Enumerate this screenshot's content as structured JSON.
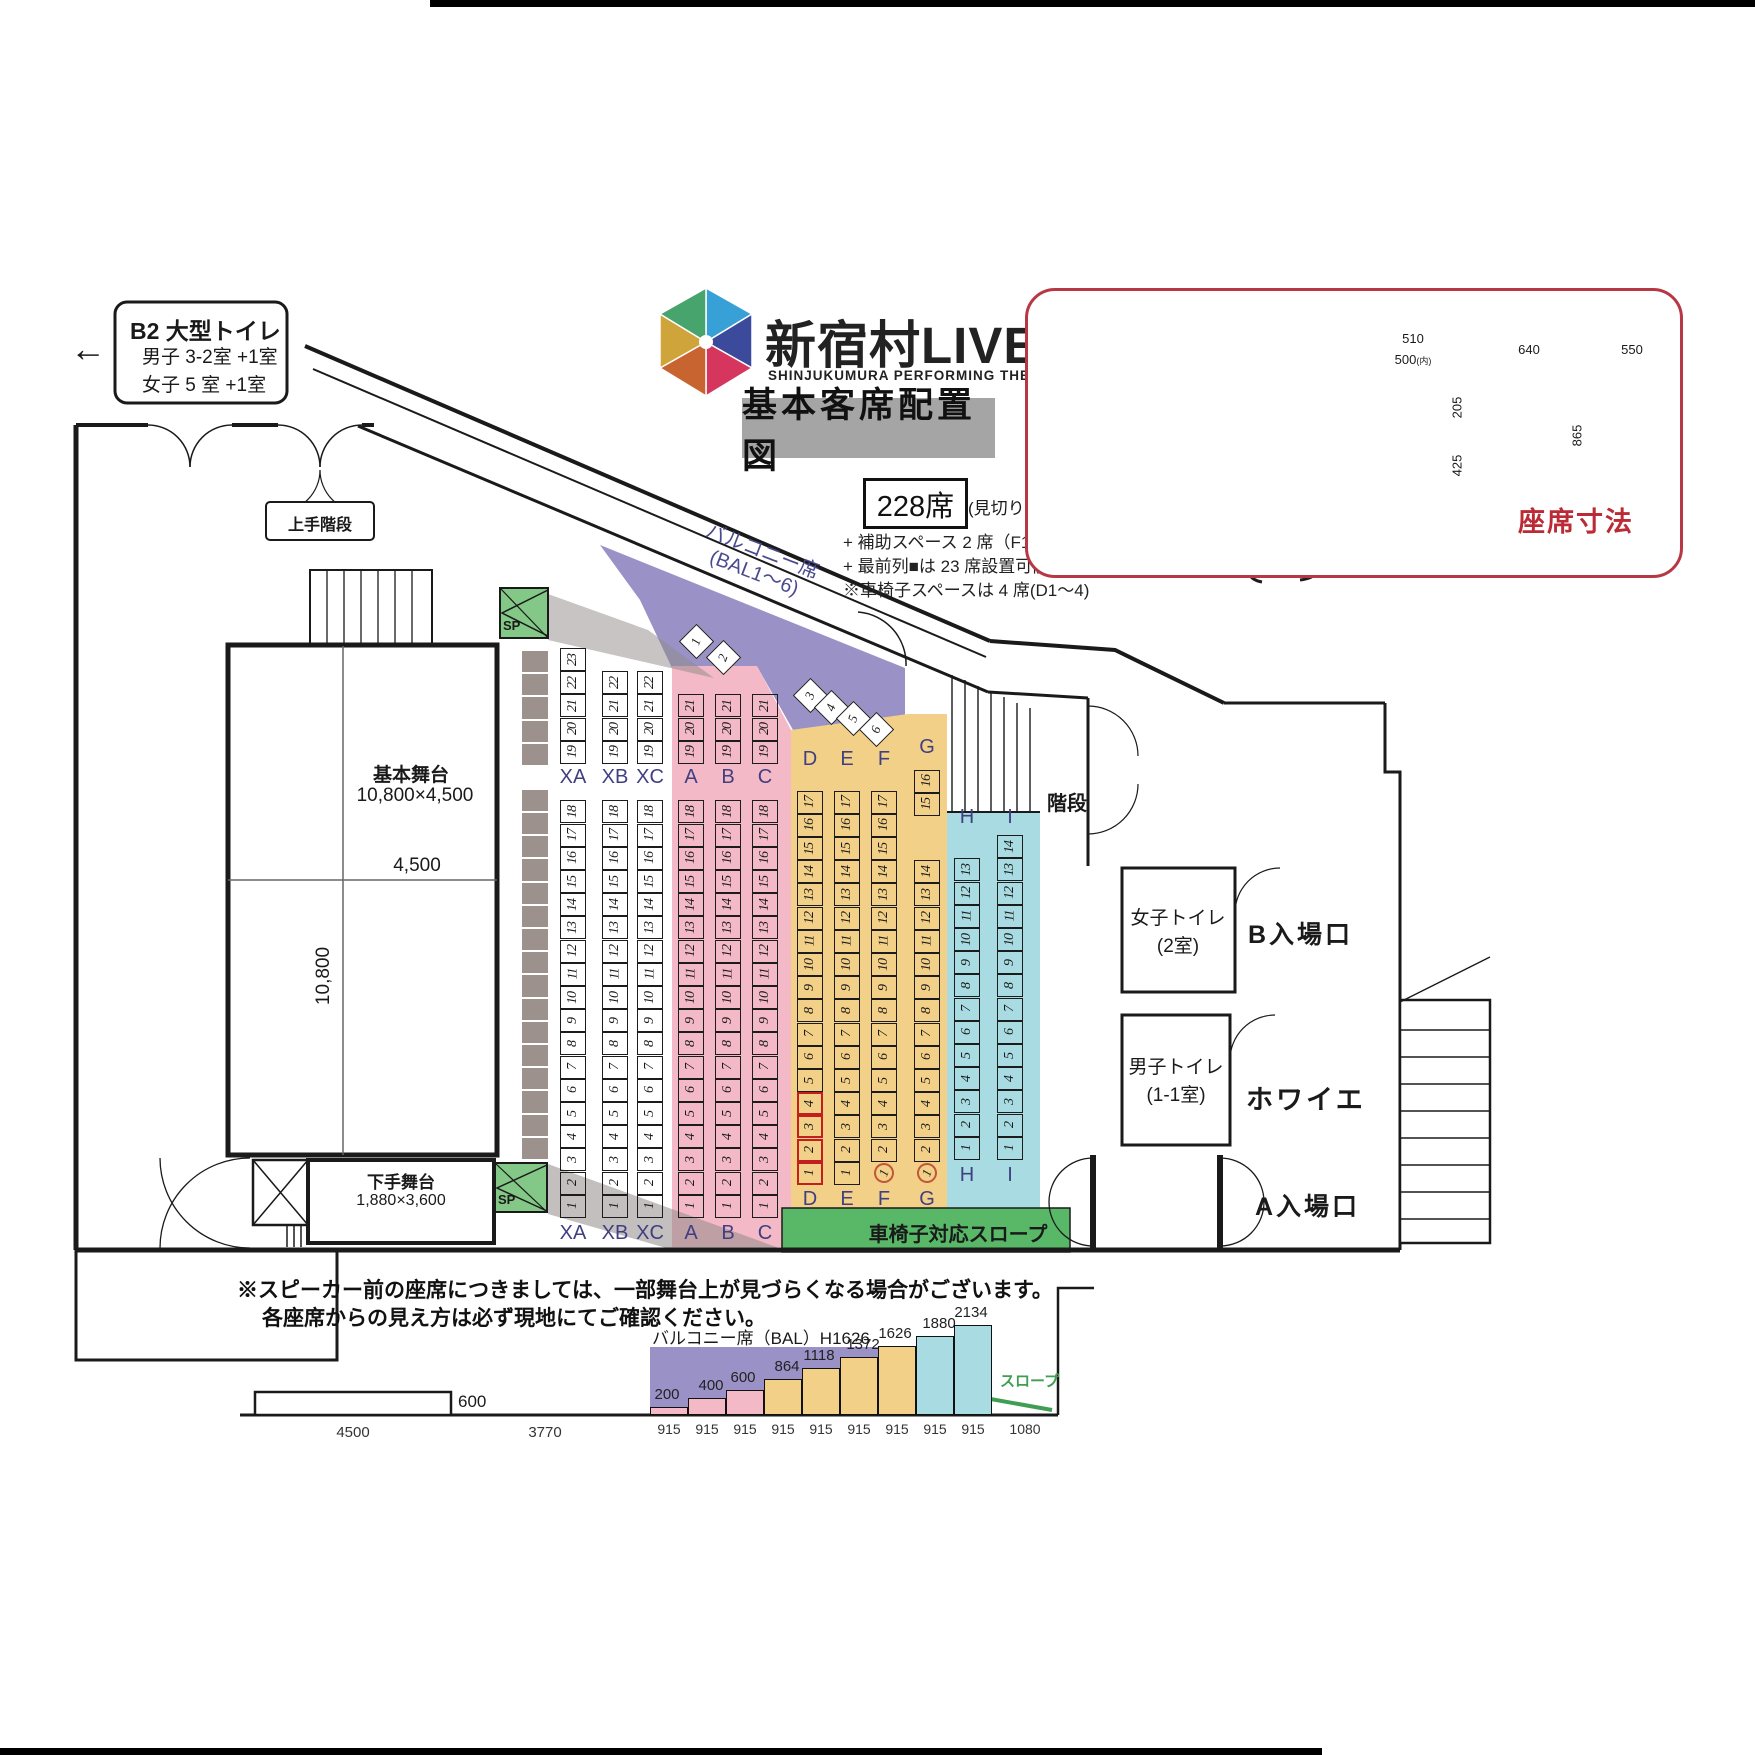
{
  "page": {
    "bg": "#ffffff"
  },
  "colors": {
    "pink": "#f3b9c6",
    "yellow": "#f2d088",
    "blue": "#a9dbe2",
    "purple": "#9a92c7",
    "ramp_green": "#58b868",
    "sp_green": "#84c888",
    "accent_red": "#bb2b36",
    "navy": "#3f3f82",
    "gray_strip": "#9c918c"
  },
  "toilet_box": {
    "arrow": "←",
    "title": "B2 大型トイレ",
    "line1": "男子 3-2室 +1室",
    "line2": "女子 5 室 +1室"
  },
  "logo": {
    "title": "新宿村LIVE",
    "subtitle": "SHINJUKUMURA PERFORMING THEAT"
  },
  "heading": {
    "plan_title": "基本客席配置図",
    "capacity": "228席",
    "capacity_note": "(見切り席含)",
    "note1": "+ 補助スペース 2 席（F1,G1）",
    "note2": "+ 最前列■は 23 席設置可能です。",
    "note3": "※車椅子スペースは 4 席(D1～4)"
  },
  "chair_panel": {
    "caption": "座席寸法",
    "front_outer_width": "510",
    "front_inner_width": "500",
    "front_inner_suffix": "(内)",
    "arm_height": "205",
    "seat_height": "425",
    "side_depth": "640",
    "total_height": "865",
    "folded_depth": "550"
  },
  "plan": {
    "stage_name": "基本舞台",
    "stage_size": "10,800×4,500",
    "stage_depth": "4,500",
    "stage_width": "10,800",
    "substage_name": "下手舞台",
    "substage_size": "1,880×3,600",
    "upper_stairs": "上手階段",
    "stairs": "階段",
    "speaker": "SP",
    "balcony_label1": "バルコニー席",
    "balcony_label2": "(BAL1～6)",
    "balcony_seats": [
      1,
      2,
      3,
      4,
      5,
      6
    ],
    "ramp_label": "車椅子対応スロープ",
    "rooms": {
      "women_toilet1": "女子トイレ",
      "women_toilet2": "(2室)",
      "men_toilet1": "男子トイレ",
      "men_toilet2": "(1-1室)",
      "entrance_b": "B入場口",
      "foyer": "ホワイエ",
      "entrance_a": "A入場口"
    },
    "seat_columns": [
      {
        "id": "XA",
        "groups": [
          {
            "from": 1,
            "to": 18
          },
          {
            "from": 19,
            "to": 23
          }
        ]
      },
      {
        "id": "XB",
        "groups": [
          {
            "from": 1,
            "to": 18
          },
          {
            "from": 19,
            "to": 22
          }
        ]
      },
      {
        "id": "XC",
        "groups": [
          {
            "from": 1,
            "to": 18
          },
          {
            "from": 19,
            "to": 22
          }
        ]
      },
      {
        "id": "A",
        "groups": [
          {
            "from": 1,
            "to": 18
          },
          {
            "from": 19,
            "to": 21
          }
        ]
      },
      {
        "id": "B",
        "groups": [
          {
            "from": 1,
            "to": 18
          },
          {
            "from": 19,
            "to": 21
          }
        ]
      },
      {
        "id": "C",
        "groups": [
          {
            "from": 1,
            "to": 18
          },
          {
            "from": 19,
            "to": 21
          }
        ]
      },
      {
        "id": "D",
        "groups": [
          {
            "from": 1,
            "to": 17
          }
        ],
        "wheelchair": [
          1,
          2,
          3,
          4
        ]
      },
      {
        "id": "E",
        "groups": [
          {
            "from": 1,
            "to": 17
          }
        ]
      },
      {
        "id": "F",
        "groups": [
          {
            "from": 1,
            "to": 17
          }
        ],
        "aux": [
          1
        ]
      },
      {
        "id": "G",
        "groups": [
          {
            "from": 1,
            "to": 14
          },
          {
            "from": 15,
            "to": 16
          }
        ],
        "aux": [
          1
        ]
      },
      {
        "id": "H",
        "groups": [
          {
            "from": 1,
            "to": 13
          }
        ]
      },
      {
        "id": "I",
        "groups": [
          {
            "from": 1,
            "to": 14
          }
        ]
      }
    ]
  },
  "section": {
    "balcony_overlay": "バルコニー席（BAL）H1626",
    "stage_height": "600",
    "stage_width": "4500",
    "gap_width": "3770",
    "steps": [
      200,
      400,
      600,
      864,
      1118,
      1372,
      1626,
      1880,
      2134
    ],
    "step_width": "915",
    "flat_width": "1080",
    "ramp": "スロープ"
  },
  "footnote": {
    "line1": "※スピーカー前の座席につきましては、一部舞台上が見づらくなる場合がございます。",
    "line2": "各座席からの見え方は必ず現地にてご確認ください。"
  }
}
